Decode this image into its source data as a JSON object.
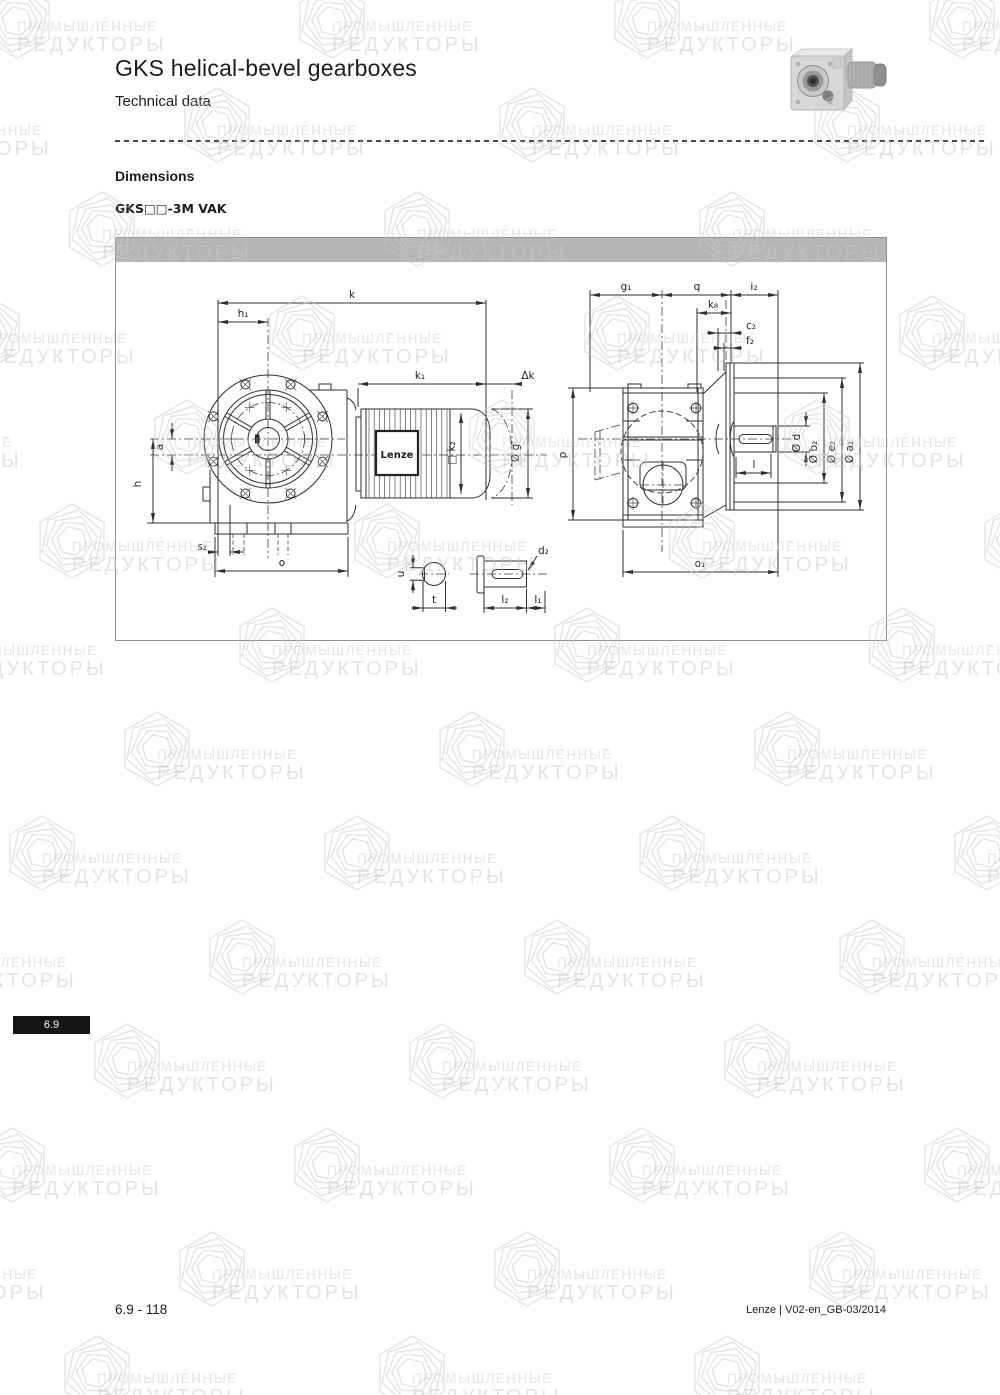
{
  "header": {
    "title": "GKS helical-bevel gearboxes",
    "subtitle": "Technical data",
    "section": "Dimensions",
    "model": "GKS□□-3M VAK"
  },
  "watermark": {
    "line1": "ПРОМЫШЛЕННЫЕ",
    "line2": "РЕДУКТОРЫ"
  },
  "drawing": {
    "motor_logo": "Lenze",
    "labels": {
      "k": "k",
      "h1": "h₁",
      "k1": "k₁",
      "dk": "Δk",
      "a": "a",
      "h": "h",
      "s2": "s₂",
      "o": "o",
      "u": "u",
      "t": "t",
      "d2": "d₂",
      "l2": "l₂",
      "l1": "l₁",
      "k2": "□ k₂",
      "g": "Ø g",
      "g1": "g₁",
      "q": "q",
      "i2": "i₂",
      "k8": "k₈",
      "c2": "c₂",
      "f2": "f₂",
      "p": "p",
      "l": "l",
      "d": "Ø d",
      "b2": "Ø b₂",
      "e2": "Ø e₂",
      "a2": "Ø a₂",
      "o1": "o₁"
    }
  },
  "sidetab": {
    "label": "6.9"
  },
  "footer": {
    "left": "6.9 - 118",
    "right": "Lenze | V02-en_GB-03/2014"
  },
  "colors": {
    "header_bar": "#b5b5b5",
    "line": "#2e2e2e",
    "tab_bg": "#141414",
    "watermark": "#c7c7c7"
  }
}
